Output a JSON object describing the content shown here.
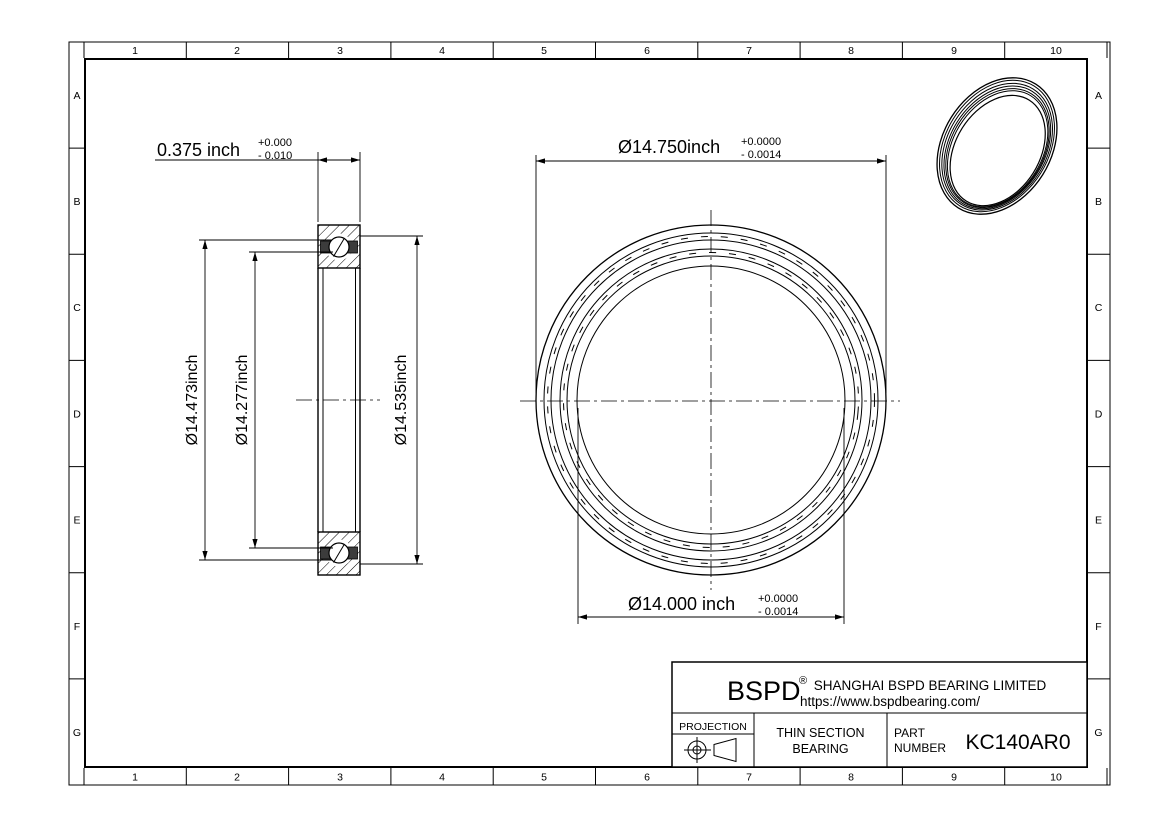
{
  "frame": {
    "columns": [
      "1",
      "2",
      "3",
      "4",
      "5",
      "6",
      "7",
      "8",
      "9",
      "10"
    ],
    "rows": [
      "A",
      "B",
      "C",
      "D",
      "E",
      "F",
      "G"
    ]
  },
  "dimensions": {
    "section_width": {
      "value": "0.375 inch",
      "tol_plus": "+0.000",
      "tol_minus": "- 0.010"
    },
    "outer_diameter": {
      "value": "Ø14.750inch",
      "tol_plus": "+0.0000",
      "tol_minus": "- 0.0014"
    },
    "bore_diameter": {
      "value": "Ø14.000 inch",
      "tol_plus": "+0.0000",
      "tol_minus": "- 0.0014"
    },
    "left_outer_diameter": "Ø14.473inch",
    "left_inner_diameter": "Ø14.277inch",
    "right_diameter": "Ø14.535inch"
  },
  "title_block": {
    "logo": "BSPD",
    "registered": "®",
    "company": "SHANGHAI BSPD BEARING LIMITED",
    "website": "https://www.bspdbearing.com/",
    "projection_label": "PROJECTION",
    "product_line1": "THIN SECTION",
    "product_line2": "BEARING",
    "part_label_line1": "PART",
    "part_label_line2": "NUMBER",
    "part_number": "KC140AR0"
  },
  "colors": {
    "line": "#000000",
    "background": "#ffffff",
    "seal_fill": "#3c3c3c"
  }
}
